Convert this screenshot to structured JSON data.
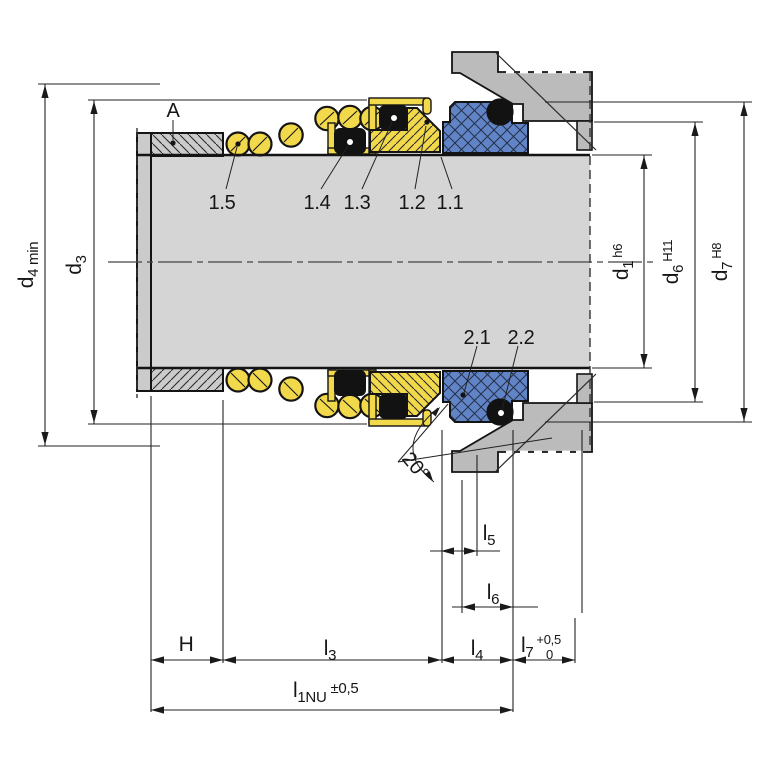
{
  "drawing_type": "mechanical-seal-installation-cross-section",
  "labels": {
    "a": "A",
    "p15": "1.5",
    "p14": "1.4",
    "p13": "1.3",
    "p12": "1.2",
    "p11": "1.1",
    "p21": "2.1",
    "p22": "2.2",
    "angle": "20°"
  },
  "dims": {
    "d4": {
      "base": "d",
      "sub": "4 min"
    },
    "d3": {
      "base": "d",
      "sub": "3"
    },
    "d1": {
      "base": "d",
      "sub": "1",
      "tol": "h6"
    },
    "d6": {
      "base": "d",
      "sub": "6",
      "tol": "H11"
    },
    "d7": {
      "base": "d",
      "sub": "7",
      "tol": "H8"
    },
    "H": {
      "base": "H"
    },
    "l3": {
      "base": "l",
      "sub": "3"
    },
    "l4": {
      "base": "l",
      "sub": "4"
    },
    "l5": {
      "base": "l",
      "sub": "5"
    },
    "l6": {
      "base": "l",
      "sub": "6"
    },
    "l7": {
      "base": "l",
      "sub": "7",
      "tol_upper": "+0,5",
      "tol_lower": "0"
    },
    "l1nu": {
      "base": "l",
      "sub": "1NU",
      "tol": "±0,5"
    }
  },
  "colors": {
    "spring_yellow": "#f2d94b",
    "seat_blue": "#6084c5",
    "shaft_gray": "#d5d5d5",
    "collar_gray": "#cbcbcb",
    "housing_gray": "#bbbbbb",
    "elastomer_black": "#121212",
    "outline": "#141414",
    "background": "#ffffff"
  }
}
